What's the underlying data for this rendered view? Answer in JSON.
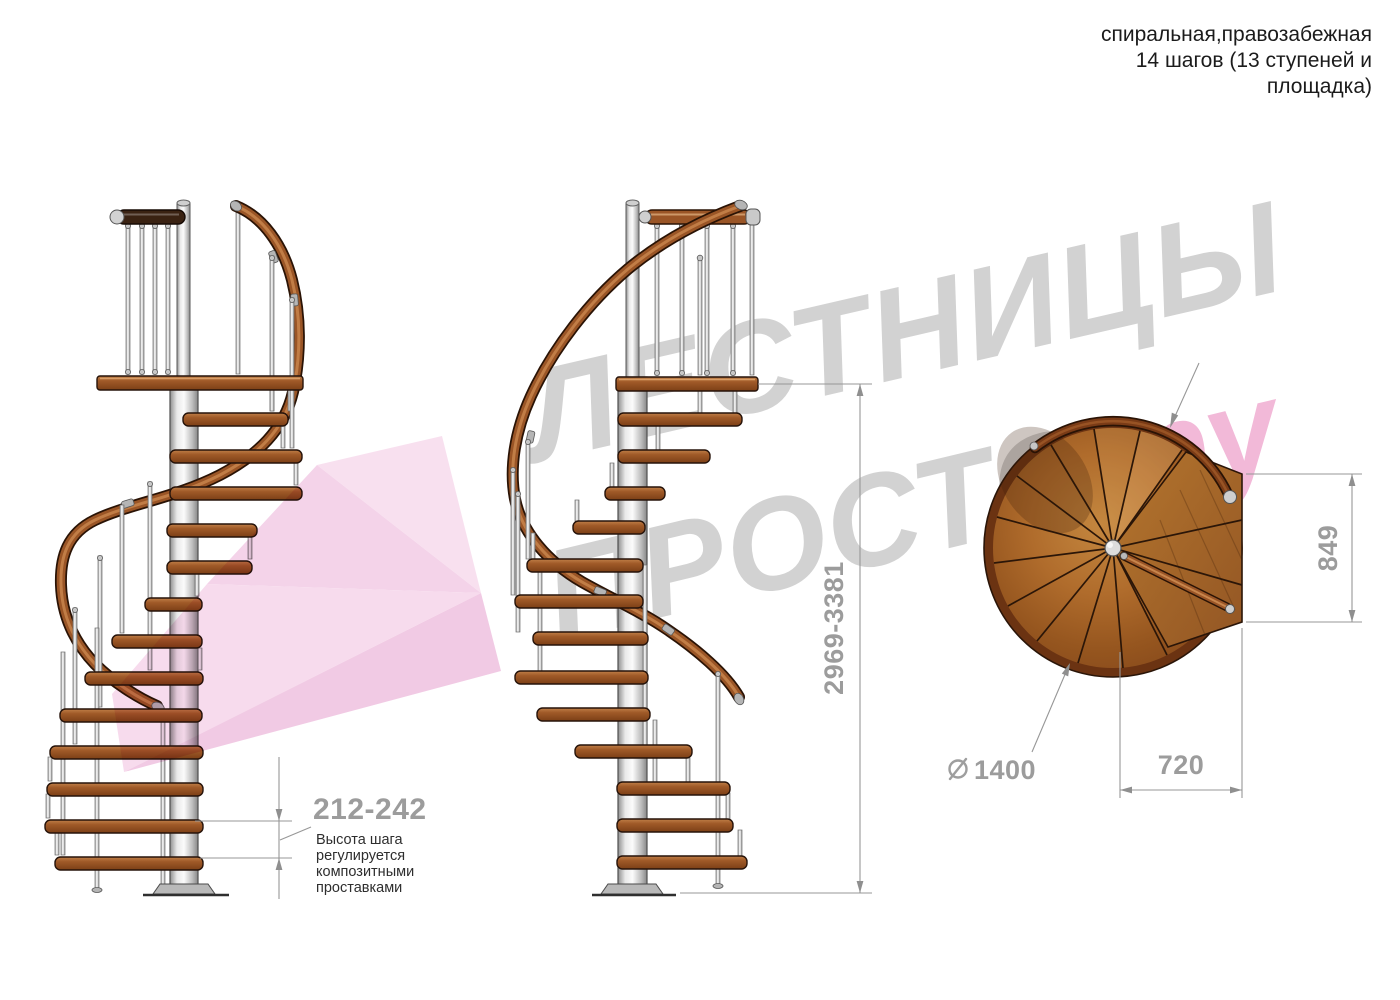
{
  "title": {
    "line1": "спиральная,правозабежная",
    "line2": "14 шагов (13 ступеней и",
    "line3": "площадка)"
  },
  "watermark": {
    "word1": "ЛЕСТНИЦЫ",
    "word2": "ПРОСТО",
    "suffix": ".ру"
  },
  "dimensions": {
    "step_height": "212-242",
    "total_height": "2969-3381",
    "landing_depth": "849",
    "step_length": "720",
    "diameter": "1400"
  },
  "annotation": {
    "line1": "Высота шага",
    "line2": "регулируется",
    "line3": "композитными",
    "line4": "проставками"
  },
  "colors": {
    "wood": "#9a5526",
    "dark_wood": "#3a2212",
    "metal": "#c9c9c9",
    "dim_gray": "#9c9c9c",
    "watermark_gray": "#d2d2d2",
    "watermark_pink": "#f2b9d8",
    "logo_pink": "#f5d3e9"
  }
}
